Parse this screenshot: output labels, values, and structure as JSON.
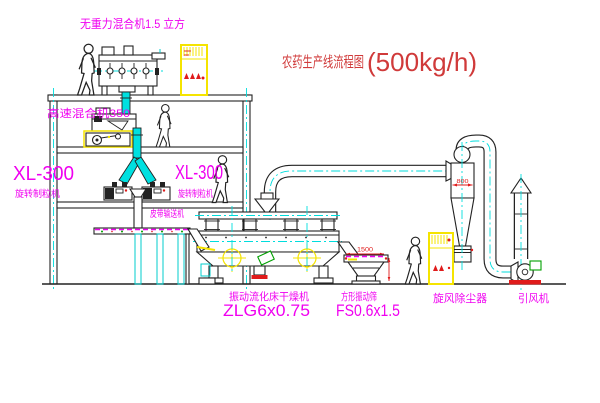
{
  "title": {
    "name": "农药生产线流程图",
    "capacity": "(500kg/h)"
  },
  "equipment_labels": {
    "gravity_mixer": "无重力混合机1.5 立方",
    "high_speed_mixer": "高速混合机350",
    "granulator_left": {
      "model": "XL-300",
      "name": "旋转制粒机"
    },
    "granulator_right": {
      "model": "XL-300",
      "name": "旋转制粒机"
    },
    "belt_conveyor": "皮带输送机",
    "fluid_bed_dryer": {
      "name": "振动流化床干燥机",
      "model": "ZLG6x0.75"
    },
    "vibrating_sieve": {
      "name": "方形振动筛",
      "model": "FS0.6x1.5"
    },
    "cyclone": "旋风除尘器",
    "induced_draft_fan": "引风机"
  },
  "dimensions": {
    "sieve_length": "1500",
    "cyclone_diameter": "800"
  },
  "colors": {
    "line": "#222222",
    "centerline_cyan": "#00dddd",
    "label_magenta": "#f000f0",
    "title_red": "#d03a3a",
    "dimension_red": "#e01b1b",
    "highlight_yellow": "#f5e400",
    "accent_green": "#00a000",
    "pipe_cyan": "#00e0e0"
  }
}
